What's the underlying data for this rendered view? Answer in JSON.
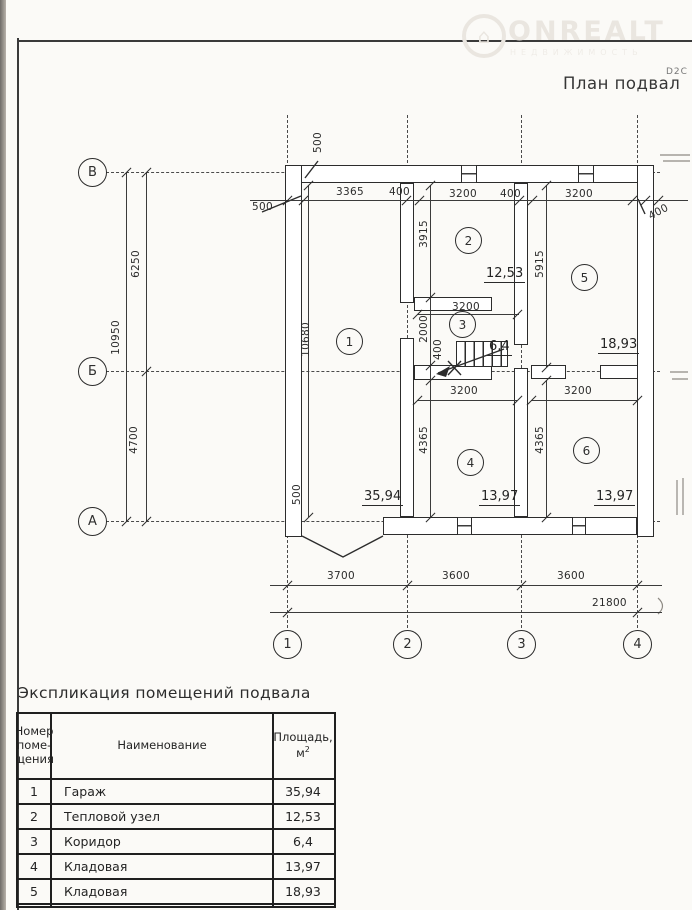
{
  "watermark": {
    "brand": "ONREALT",
    "subtitle": "НЕДВИЖИМОСТЬ",
    "logo_glyph": "⌂"
  },
  "title": {
    "text": "План подвал",
    "superscript": "D2C"
  },
  "plan": {
    "axes_h": [
      "В",
      "Б",
      "А"
    ],
    "axes_v": [
      "1",
      "2",
      "3",
      "4"
    ],
    "rooms": [
      "1",
      "2",
      "3",
      "4",
      "5",
      "6"
    ],
    "areas": [
      "35,94",
      "12,53",
      "6,4",
      "13,97",
      "18,93",
      "13,97"
    ],
    "labels": [
      "500",
      "3365",
      "400",
      "3200",
      "400",
      "3200",
      "400",
      "500",
      "10950",
      "6250",
      "4700",
      "10680",
      "500",
      "3915",
      "2000",
      "400",
      "5915",
      "4365",
      "4365",
      "3200",
      "3200",
      "3200",
      "3700",
      "3600",
      "3600",
      "21800"
    ]
  },
  "table": {
    "title": "Экспликация помещений подвала",
    "headers": {
      "num_lines": [
        "Номер",
        "поме-",
        "щения"
      ],
      "name": "Наименование",
      "area_line1": "Площадь,",
      "area_unit": "м",
      "area_sup": "2"
    },
    "rows": [
      {
        "num": "1",
        "name": "Гараж",
        "area": "35,94"
      },
      {
        "num": "2",
        "name": "Тепловой узел",
        "area": "12,53"
      },
      {
        "num": "3",
        "name": "Коридор",
        "area": "6,4"
      },
      {
        "num": "4",
        "name": "Кладовая",
        "area": "13,97"
      },
      {
        "num": "5",
        "name": "Кладовая",
        "area": "18,93"
      }
    ]
  }
}
